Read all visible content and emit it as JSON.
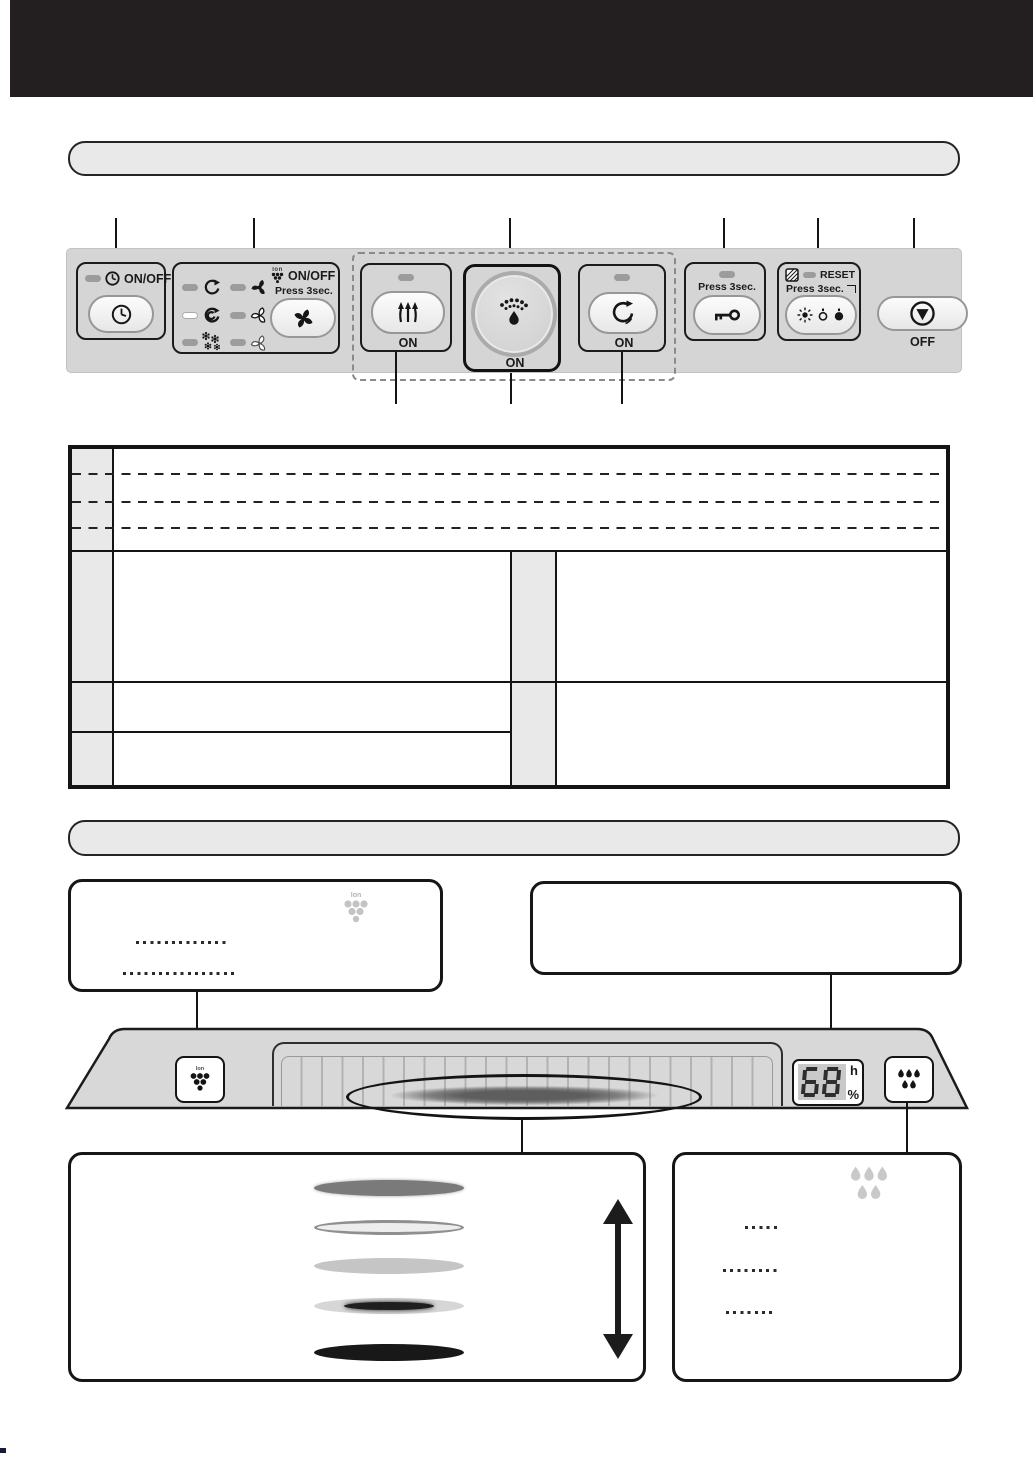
{
  "page": {
    "header_bar_color": "#231f20",
    "section1_title": "",
    "section2_title": ""
  },
  "colors": {
    "panel_bg": "#d5d5d5",
    "group_border": "#1b1b1b",
    "title_bar_bg": "#e9e9e9",
    "table_label_cell_bg": "#e9e9e9",
    "led_off": "#9c9c9c",
    "led_on": "#ffffff",
    "display_digit_bg": "#c9c9c9"
  },
  "control_panel": {
    "timer": {
      "onoff_label": "ON/OFF"
    },
    "mode": {
      "ion_label": "Ion",
      "ion_onoff_label": "ON/OFF",
      "press_label": "Press 3sec."
    },
    "louver": {
      "on_label": "ON"
    },
    "humidify": {
      "on_label": "ON"
    },
    "swing": {
      "on_label": "ON"
    },
    "child_lock": {
      "press_label": "Press 3sec."
    },
    "brightness": {
      "reset_label": "RESET",
      "press_label": "Press 3sec."
    },
    "power_off": {
      "label": "OFF"
    }
  },
  "device": {
    "ion_label": "Ion",
    "display": {
      "value": "68",
      "unit_top": "h",
      "unit_bottom": "%"
    }
  },
  "callout_boxes": {
    "ion_box": {
      "ion_label": "Ion"
    },
    "drops_box": {}
  },
  "icons": [
    "clock-icon",
    "swirl-auto-icon",
    "swirl-turbo-icon",
    "pollen-icon",
    "fan-high-icon",
    "fan-medium-icon",
    "fan-low-icon",
    "propeller-icon",
    "ion-cluster-icon",
    "louver-up-icon",
    "mist-icon",
    "rotate-icon",
    "key-icon",
    "filter-hatch-icon",
    "brightness-bright-icon",
    "brightness-dim-icon",
    "brightness-off-icon",
    "stop-icon",
    "water-drops-icon"
  ]
}
